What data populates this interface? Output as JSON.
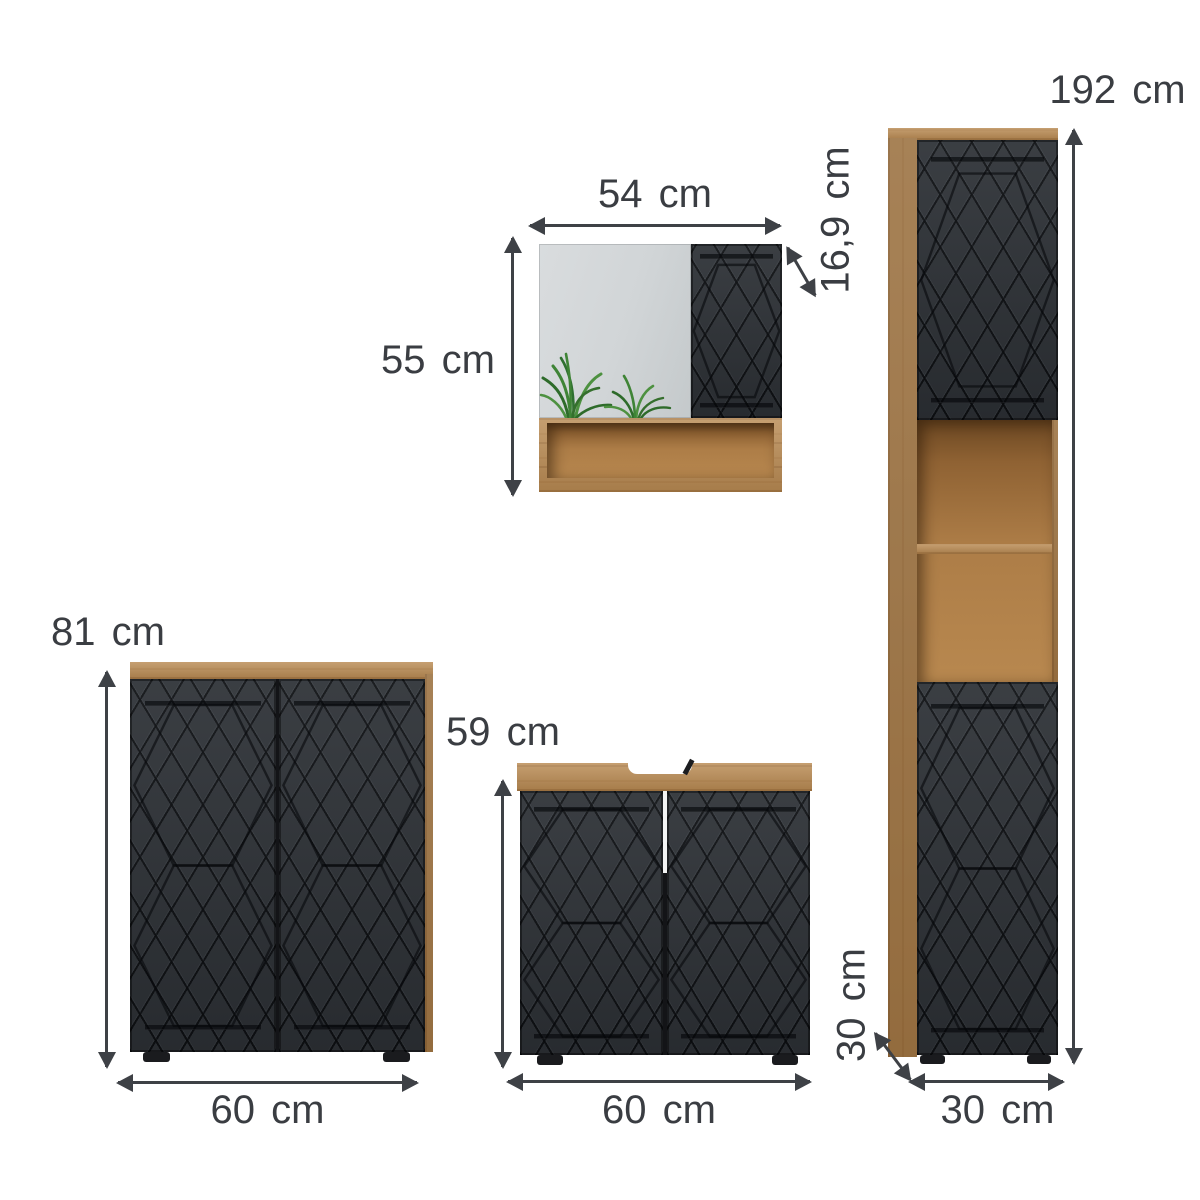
{
  "diagram": {
    "background_color": "#ffffff",
    "arrow_color": "#3e4146",
    "text_color": "#3a3d42",
    "oak_color": "#b5854d",
    "front_panel_color": "#2f3338",
    "mirror_color": "#d3d7d9",
    "plant_color": "#3f8436",
    "pieces": {
      "mirror_cabinet": {
        "width": "54 cm",
        "height": "55 cm",
        "depth": "16,9 cm"
      },
      "tall_cabinet": {
        "height": "192 cm",
        "depth": "30 cm",
        "width": "30 cm"
      },
      "side_cabinet": {
        "height": "81 cm",
        "width": "60 cm"
      },
      "sink_cabinet": {
        "height": "59 cm",
        "width": "60 cm"
      }
    }
  }
}
